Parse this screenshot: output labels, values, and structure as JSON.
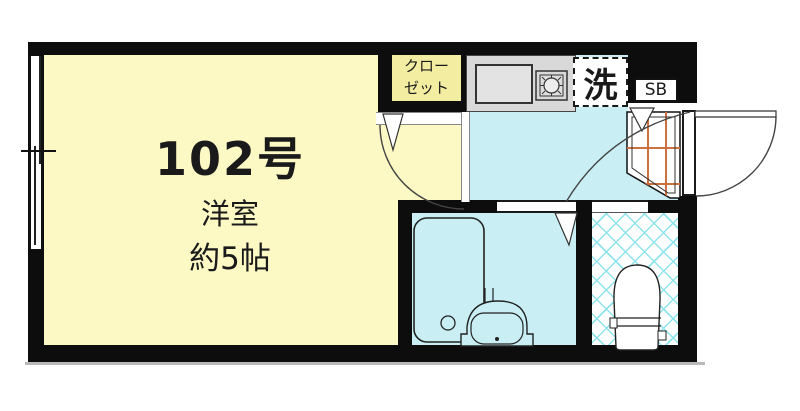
{
  "plan": {
    "room_number": "102号",
    "room_type": "洋室",
    "room_size": "約5帖",
    "closet_line1": "クロー",
    "closet_line2": "ゼット",
    "laundry": "洗",
    "shoe_box": "SB"
  },
  "colors": {
    "wall": "#0d0d0d",
    "main_room": "#fdf9c5",
    "closet": "#f3eda1",
    "wet_floor": "#c9eff5",
    "counter": "#d9d9d9",
    "sink": "#e3e3e3",
    "genkan_grid": "#cc7040",
    "tile_hatch": "#8ee3ec",
    "door_line": "#444444"
  }
}
